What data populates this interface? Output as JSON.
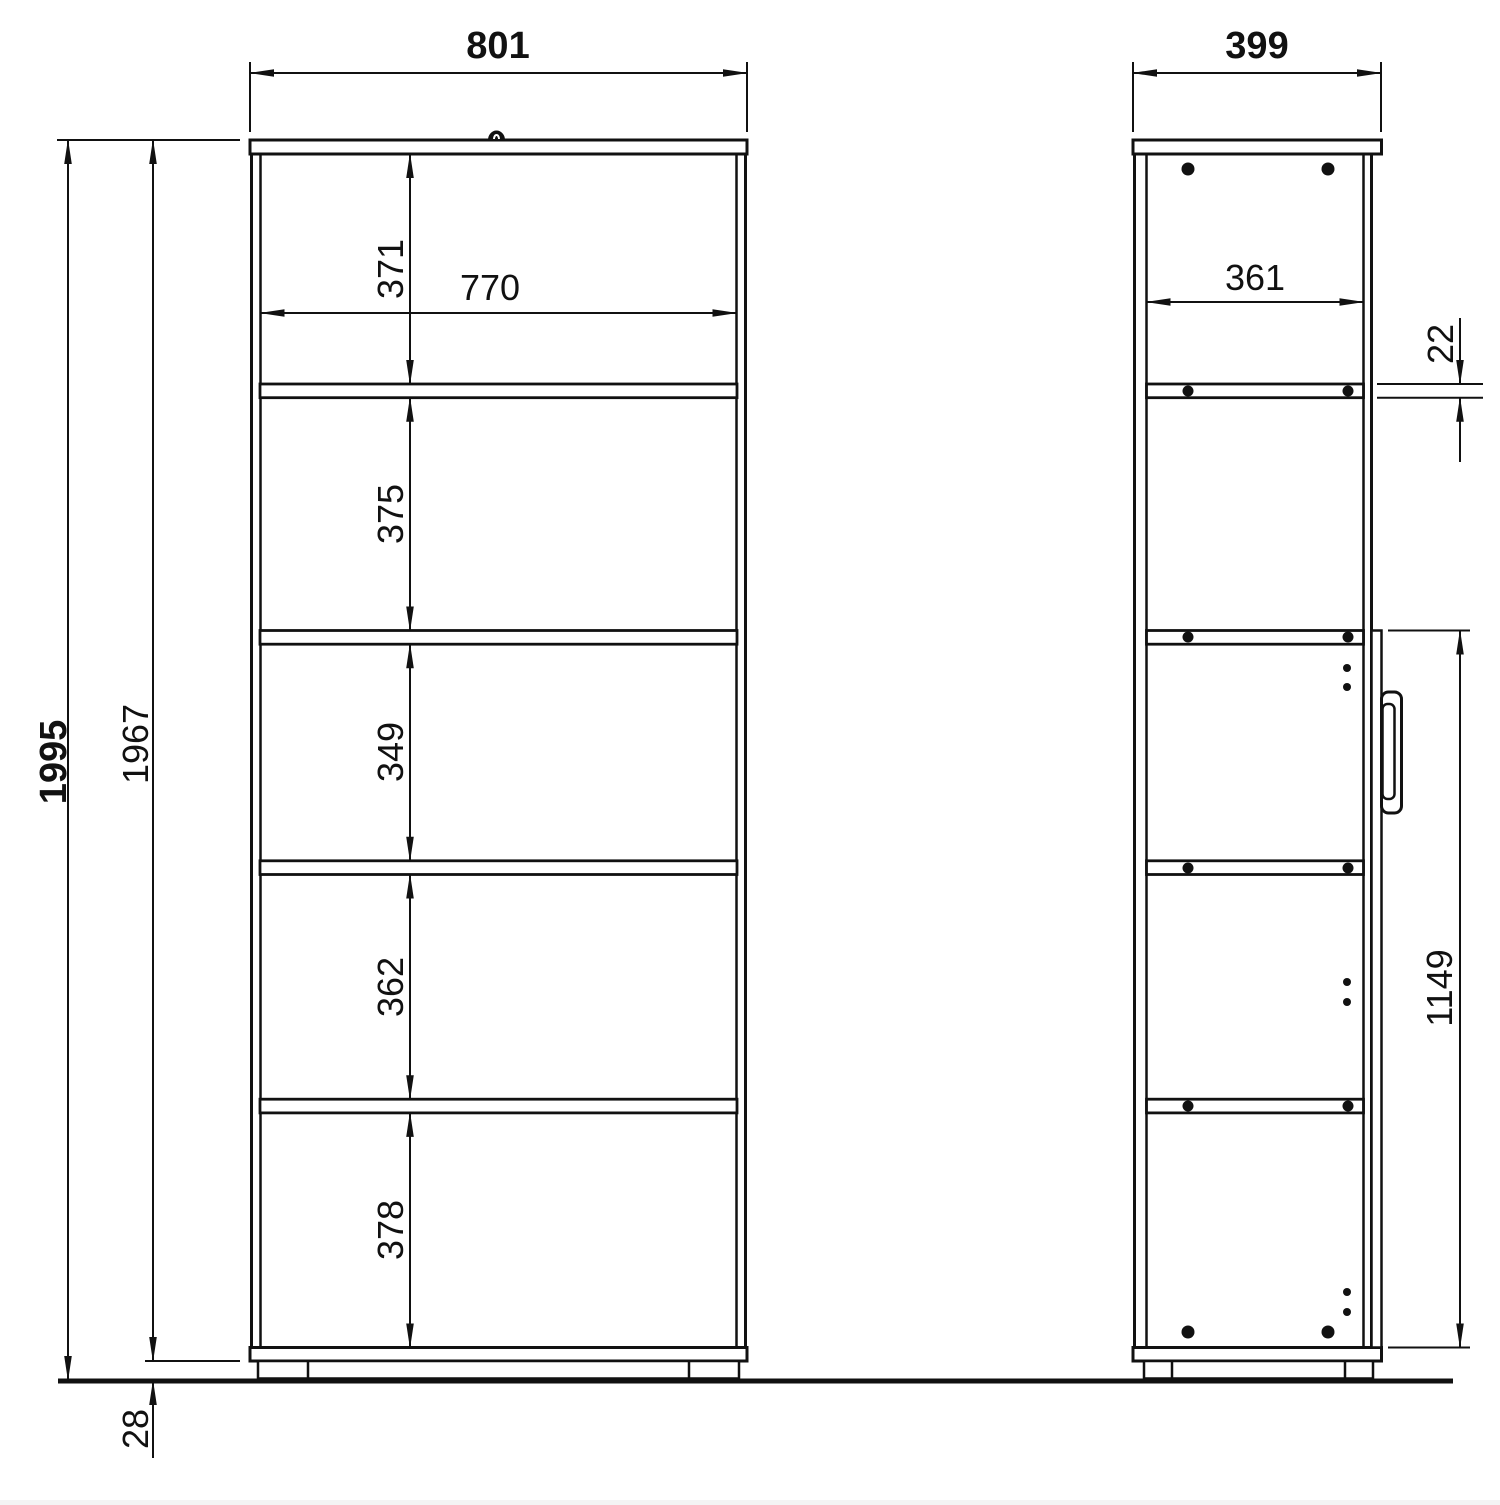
{
  "drawing_title": "cabinet-two-view-dimension-drawing",
  "colors": {
    "background": "#ffffff",
    "line": "#111111"
  },
  "front_view": {
    "name": "front view",
    "dims": {
      "overall_width": "801",
      "inner_width": "770",
      "overall_height": "1995",
      "body_height": "1967",
      "feet_height": "28",
      "section_1": "371",
      "section_2": "375",
      "section_3": "349",
      "section_4": "362",
      "section_5": "378"
    }
  },
  "side_view": {
    "name": "side view",
    "dims": {
      "overall_depth": "399",
      "inner_depth": "361",
      "shelf_thickness": "22",
      "door_height": "1149"
    }
  }
}
